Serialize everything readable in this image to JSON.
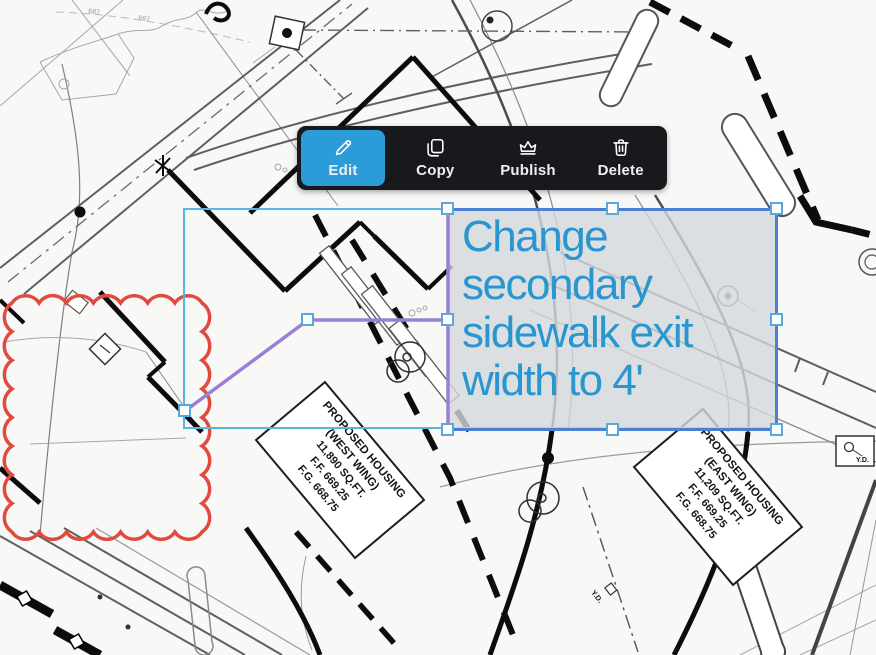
{
  "toolbar": {
    "items": [
      {
        "label": "Edit",
        "icon": "pencil-icon",
        "active": true
      },
      {
        "label": "Copy",
        "icon": "copy-icon",
        "active": false
      },
      {
        "label": "Publish",
        "icon": "crown-icon",
        "active": false
      },
      {
        "label": "Delete",
        "icon": "trash-icon",
        "active": false
      }
    ],
    "active_color": "#2b9cd8"
  },
  "annotation": {
    "text": "Change secondary sidewalk exit width to 4'",
    "text_color": "#2a96cf",
    "box_border_color": "#4a7fd2",
    "leader_color": "#9b7fd6",
    "selection_color": "#58b7e1",
    "handle_border_color": "#58a9d9"
  },
  "plan": {
    "revision_cloud_color": "#e14a3e",
    "labels": {
      "west_wing": [
        "PROPOSED HOUSING",
        "(WEST WING)",
        "11,890 SQ.FT.",
        "F.F. 669.25",
        "F.G. 668.75"
      ],
      "east_wing": [
        "PROPOSED HOUSING",
        "(EAST WING)",
        "11,209 SQ.FT.",
        "F.F. 669.25",
        "F.G. 668.75"
      ],
      "yard_drain_1": "Y.D.",
      "yard_drain_2": "Y.D.",
      "contour": "687"
    }
  }
}
